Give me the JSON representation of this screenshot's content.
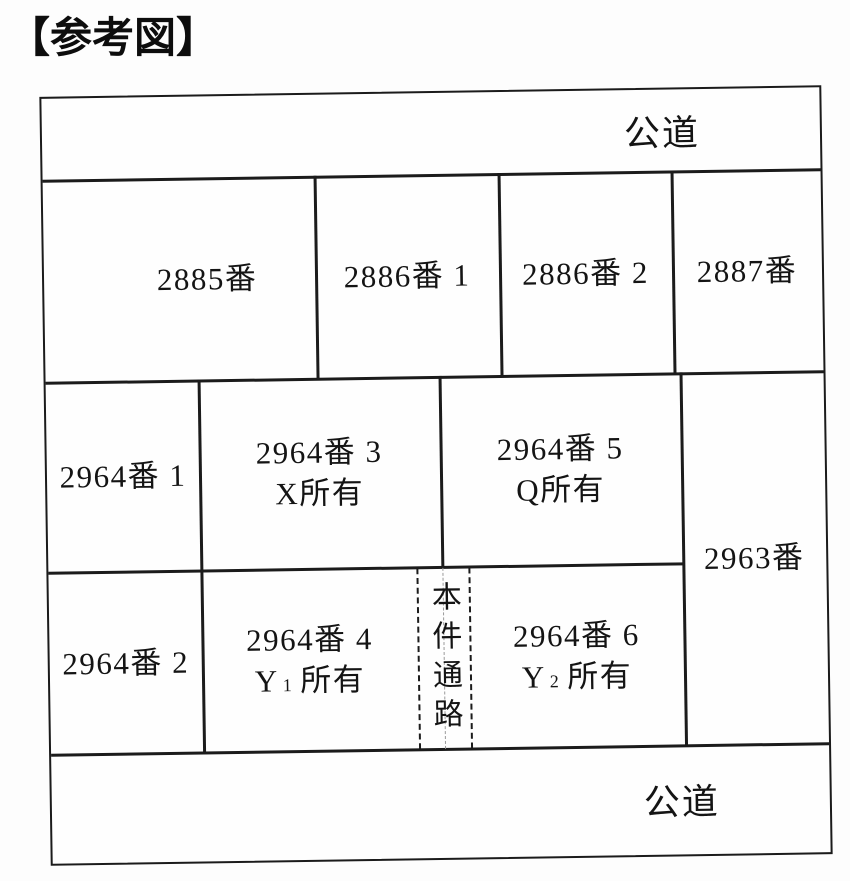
{
  "title": "【参考図】",
  "colors": {
    "ink": "#1b1b1b",
    "paper": "#fefefe"
  },
  "roads": {
    "top": "公道",
    "bottom": "公道"
  },
  "parcels": {
    "p2885": {
      "label": "2885番"
    },
    "p2886_1": {
      "label": "2886番 1"
    },
    "p2886_2": {
      "label": "2886番 2"
    },
    "p2887": {
      "label": "2887番"
    },
    "p2964_1": {
      "label": "2964番 1"
    },
    "p2964_3": {
      "label": "2964番 3",
      "owner": "X所有"
    },
    "p2964_5": {
      "label": "2964番 5",
      "owner": "Q所有"
    },
    "p2963": {
      "label": "2963番"
    },
    "p2964_2": {
      "label": "2964番 2"
    },
    "p2964_4": {
      "label": "2964番 4",
      "owner_prefix": "Y",
      "owner_sub": "1",
      "owner_suffix": "所有"
    },
    "p2964_6": {
      "label": "2964番 6",
      "owner_prefix": "Y",
      "owner_sub": "2",
      "owner_suffix": "所有"
    },
    "passage": {
      "label": "本件通路"
    }
  }
}
